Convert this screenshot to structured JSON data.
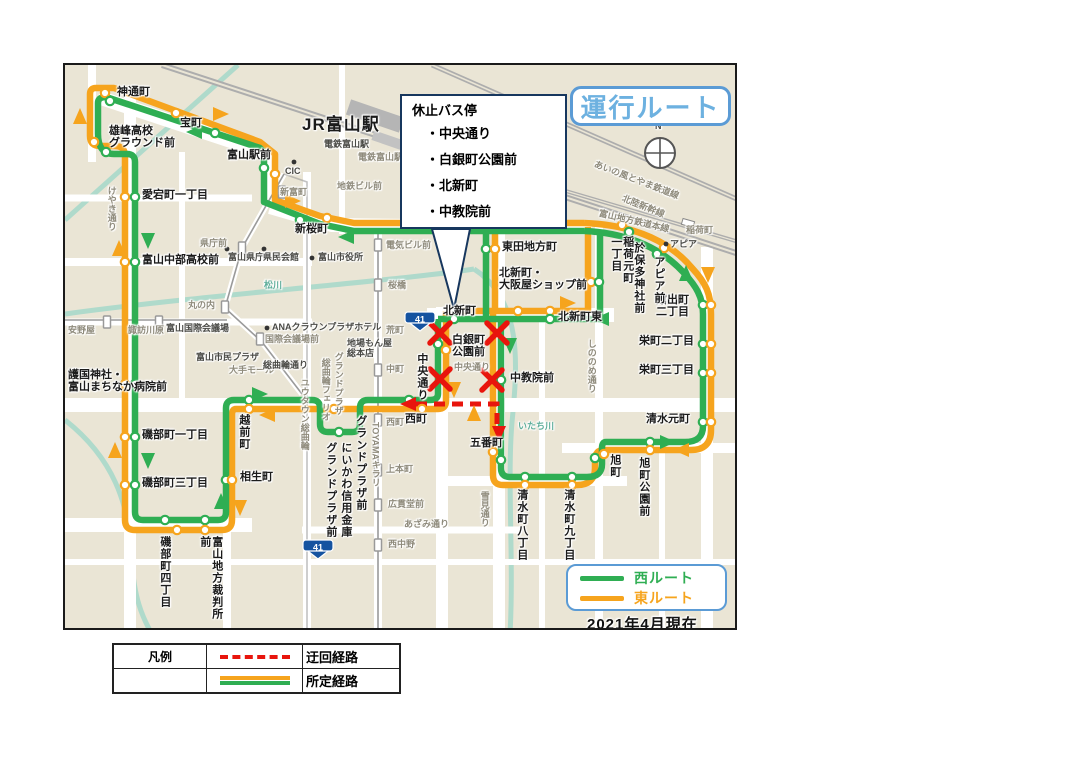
{
  "title": "運行ルート",
  "note": "2021年4月現在",
  "compass_n": "N",
  "callout": {
    "title": "休止バス停",
    "items": [
      "・中央通り",
      "・白銀町公園前",
      "・北新町",
      "・中教院前"
    ]
  },
  "route_legend": {
    "west": "西ルート",
    "east": "東ルート"
  },
  "legend_table": {
    "header": "凡例",
    "rows": [
      {
        "label": "迂回経路"
      },
      {
        "label": "所定経路"
      }
    ]
  },
  "colors": {
    "green": "#2fae53",
    "orange": "#f6a41d",
    "red": "#e8150d",
    "title_blue": "#6db1e0",
    "box_border_blue": "#5b9bd5",
    "water": "#a9d8ca",
    "rail": "#adadad",
    "map_bg": "#eae5d5",
    "shield_blue": "#1553a0"
  },
  "shields": [
    {
      "num": "41",
      "x": 418,
      "y": 318
    },
    {
      "num": "41",
      "x": 316,
      "y": 546
    }
  ],
  "map": {
    "labels": [
      {
        "t": "神通町",
        "x": 115,
        "y": 85,
        "cls": "s"
      },
      {
        "t": "宝町",
        "x": 178,
        "y": 116,
        "cls": "s"
      },
      {
        "t": "雄峰高校\nグラウンド前",
        "x": 107,
        "y": 124,
        "cls": "s"
      },
      {
        "t": "愛宕町一丁目",
        "x": 140,
        "y": 188,
        "cls": "s"
      },
      {
        "t": "富山中部高校前",
        "x": 140,
        "y": 253,
        "cls": "s"
      },
      {
        "t": "護国神社・\n富山まちなか病院前",
        "x": 66,
        "y": 368,
        "cls": "s"
      },
      {
        "t": "磯部町一丁目",
        "x": 140,
        "y": 428,
        "cls": "s"
      },
      {
        "t": "磯部町三丁目",
        "x": 140,
        "y": 476,
        "cls": "s"
      },
      {
        "t": "磯部町四丁目",
        "x": 156,
        "y": 534,
        "cls": "v"
      },
      {
        "t": "富山地方裁判所前",
        "x": 196,
        "y": 534,
        "cls": "v"
      },
      {
        "t": "相生町",
        "x": 238,
        "y": 470,
        "cls": "s"
      },
      {
        "t": "越前町",
        "x": 235,
        "y": 412,
        "cls": "v"
      },
      {
        "t": "グランドプラザ前",
        "x": 352,
        "y": 413,
        "cls": "v"
      },
      {
        "t": "にいかわ信用金庫",
        "x": 337,
        "y": 440,
        "cls": "v"
      },
      {
        "t": "グランドプラザ前",
        "x": 322,
        "y": 440,
        "cls": "v"
      },
      {
        "t": "TOYAMAキラリ",
        "x": 368,
        "y": 420,
        "cls": "vg"
      },
      {
        "t": "西町",
        "x": 403,
        "y": 412,
        "cls": "s"
      },
      {
        "t": "富山駅前",
        "x": 225,
        "y": 148,
        "cls": "s"
      },
      {
        "t": "JR富山駅",
        "x": 300,
        "y": 114,
        "cls": "sb"
      },
      {
        "t": "電鉄富山駅",
        "x": 322,
        "y": 138,
        "cls": "sm2"
      },
      {
        "t": "電鉄富山駅エスタ前",
        "x": 356,
        "y": 151,
        "cls": "sm"
      },
      {
        "t": "CIC",
        "x": 283,
        "y": 165,
        "cls": "sm2"
      },
      {
        "t": "新富町",
        "x": 278,
        "y": 186,
        "cls": "sm"
      },
      {
        "t": "地鉄ビル前",
        "x": 335,
        "y": 180,
        "cls": "sm"
      },
      {
        "t": "新桜町",
        "x": 293,
        "y": 222,
        "cls": "s"
      },
      {
        "t": "電気ビル前",
        "x": 384,
        "y": 239,
        "cls": "sm"
      },
      {
        "t": "桜橋",
        "x": 386,
        "y": 279,
        "cls": "sm"
      },
      {
        "t": "県庁前",
        "x": 198,
        "y": 237,
        "cls": "sm"
      },
      {
        "t": "富山県庁",
        "x": 226,
        "y": 251,
        "cls": "sm2"
      },
      {
        "t": "県民会館",
        "x": 261,
        "y": 251,
        "cls": "sm2"
      },
      {
        "t": "富山市役所",
        "x": 316,
        "y": 251,
        "cls": "sm2"
      },
      {
        "t": "松川",
        "x": 262,
        "y": 279,
        "cls": "teal"
      },
      {
        "t": "丸の内",
        "x": 186,
        "y": 299,
        "cls": "sm"
      },
      {
        "t": "安野屋",
        "x": 66,
        "y": 324,
        "cls": "sm"
      },
      {
        "t": "諏訪川原",
        "x": 126,
        "y": 324,
        "cls": "sm"
      },
      {
        "t": "富山国際会議場",
        "x": 164,
        "y": 322,
        "cls": "sm2"
      },
      {
        "t": "ANAクラウンプラザホテル",
        "x": 270,
        "y": 321,
        "cls": "sm2"
      },
      {
        "t": "国際会議場前",
        "x": 263,
        "y": 333,
        "cls": "sm"
      },
      {
        "t": "富山市民プラザ",
        "x": 194,
        "y": 351,
        "cls": "sm2"
      },
      {
        "t": "大手モール",
        "x": 227,
        "y": 364,
        "cls": "sm"
      },
      {
        "t": "総曲輪通り",
        "x": 261,
        "y": 359,
        "cls": "sm2"
      },
      {
        "t": "地場もん屋\n総本店",
        "x": 345,
        "y": 337,
        "cls": "sm2"
      },
      {
        "t": "グランドプラザ",
        "x": 331,
        "y": 350,
        "cls": "vg"
      },
      {
        "t": "総曲輪フェリオ",
        "x": 318,
        "y": 356,
        "cls": "vg"
      },
      {
        "t": "ユウタウン総曲輪",
        "x": 297,
        "y": 376,
        "cls": "vg"
      },
      {
        "t": "中町",
        "x": 384,
        "y": 363,
        "cls": "sm"
      },
      {
        "t": "荒町",
        "x": 384,
        "y": 324,
        "cls": "sm"
      },
      {
        "t": "西町",
        "x": 384,
        "y": 416,
        "cls": "sm"
      },
      {
        "t": "上本町",
        "x": 384,
        "y": 463,
        "cls": "sm"
      },
      {
        "t": "広貫堂前",
        "x": 386,
        "y": 498,
        "cls": "sm"
      },
      {
        "t": "西中野",
        "x": 386,
        "y": 538,
        "cls": "sm"
      },
      {
        "t": "あざみ通り",
        "x": 402,
        "y": 518,
        "cls": "sm"
      },
      {
        "t": "雪見通り",
        "x": 477,
        "y": 489,
        "cls": "vg"
      },
      {
        "t": "けやき通り",
        "x": 104,
        "y": 184,
        "cls": "vg"
      },
      {
        "t": "しののめ通り",
        "x": 584,
        "y": 337,
        "cls": "vg"
      },
      {
        "t": "いたち川",
        "x": 516,
        "y": 420,
        "cls": "teal"
      },
      {
        "t": "東田地方町",
        "x": 500,
        "y": 240,
        "cls": "s"
      },
      {
        "t": "北新町・\n大阪屋ショップ前",
        "x": 497,
        "y": 266,
        "cls": "s"
      },
      {
        "t": "北新町",
        "x": 441,
        "y": 304,
        "cls": "s"
      },
      {
        "t": "北新町東",
        "x": 556,
        "y": 310,
        "cls": "s"
      },
      {
        "t": "白銀町\n公園前",
        "x": 450,
        "y": 333,
        "cls": "s"
      },
      {
        "t": "中央通り",
        "x": 452,
        "y": 361,
        "cls": "sm"
      },
      {
        "t": "中央通り",
        "x": 413,
        "y": 351,
        "cls": "v"
      },
      {
        "t": "中教院前",
        "x": 508,
        "y": 371,
        "cls": "s"
      },
      {
        "t": "五番町",
        "x": 468,
        "y": 436,
        "cls": "s"
      },
      {
        "t": "清水町八丁目",
        "x": 513,
        "y": 487,
        "cls": "v"
      },
      {
        "t": "清水町九丁目",
        "x": 560,
        "y": 487,
        "cls": "v"
      },
      {
        "t": "旭町",
        "x": 606,
        "y": 452,
        "cls": "v"
      },
      {
        "t": "旭町公園前",
        "x": 635,
        "y": 455,
        "cls": "v"
      },
      {
        "t": "清水元町",
        "x": 644,
        "y": 412,
        "cls": "s"
      },
      {
        "t": "栄町二丁目",
        "x": 637,
        "y": 334,
        "cls": "s"
      },
      {
        "t": "栄町三丁目",
        "x": 637,
        "y": 363,
        "cls": "s"
      },
      {
        "t": "館出町\n二丁目",
        "x": 654,
        "y": 293,
        "cls": "s"
      },
      {
        "t": "アピア前",
        "x": 650,
        "y": 254,
        "cls": "v"
      },
      {
        "t": "稲荷元町\n一丁目",
        "x": 607,
        "y": 234,
        "cls": "v"
      },
      {
        "t": "於保多神社前",
        "x": 630,
        "y": 240,
        "cls": "v"
      },
      {
        "t": "アピア",
        "x": 668,
        "y": 238,
        "cls": "sm2"
      },
      {
        "t": "稲荷町",
        "x": 684,
        "y": 224,
        "cls": "sm"
      },
      {
        "t": "富山地方鉄道本線",
        "x": 598,
        "y": 207,
        "cls": "sm",
        "rot": 13
      },
      {
        "t": "あいの風とやま鉄道線",
        "x": 594,
        "y": 158,
        "cls": "sm",
        "rot": 21
      },
      {
        "t": "北陸新幹線",
        "x": 622,
        "y": 192,
        "cls": "sm",
        "rot": 22
      },
      {
        "t": "N",
        "x": 653,
        "y": 120,
        "cls": "sm2"
      }
    ],
    "stops": [
      {
        "x": 103,
        "y": 91,
        "c": "o"
      },
      {
        "x": 108,
        "y": 99,
        "c": "g"
      },
      {
        "x": 174,
        "y": 111,
        "c": "o"
      },
      {
        "x": 213,
        "y": 131,
        "c": "g"
      },
      {
        "x": 92,
        "y": 140,
        "c": "o"
      },
      {
        "x": 104,
        "y": 150,
        "c": "g"
      },
      {
        "x": 123,
        "y": 195,
        "c": "o"
      },
      {
        "x": 133,
        "y": 195,
        "c": "g"
      },
      {
        "x": 123,
        "y": 260,
        "c": "o"
      },
      {
        "x": 133,
        "y": 260,
        "c": "g"
      },
      {
        "x": 123,
        "y": 382,
        "c": "o"
      },
      {
        "x": 133,
        "y": 382,
        "c": "g"
      },
      {
        "x": 123,
        "y": 435,
        "c": "o"
      },
      {
        "x": 133,
        "y": 435,
        "c": "g"
      },
      {
        "x": 123,
        "y": 483,
        "c": "o"
      },
      {
        "x": 133,
        "y": 483,
        "c": "g"
      },
      {
        "x": 163,
        "y": 518,
        "c": "g"
      },
      {
        "x": 175,
        "y": 528,
        "c": "o"
      },
      {
        "x": 203,
        "y": 518,
        "c": "g"
      },
      {
        "x": 203,
        "y": 528,
        "c": "o"
      },
      {
        "x": 224,
        "y": 478,
        "c": "g"
      },
      {
        "x": 230,
        "y": 478,
        "c": "o"
      },
      {
        "x": 247,
        "y": 398,
        "c": "g"
      },
      {
        "x": 247,
        "y": 407,
        "c": "o"
      },
      {
        "x": 332,
        "y": 407,
        "c": "o"
      },
      {
        "x": 337,
        "y": 430,
        "c": "g"
      },
      {
        "x": 407,
        "y": 398,
        "c": "g"
      },
      {
        "x": 420,
        "y": 407,
        "c": "o"
      },
      {
        "x": 262,
        "y": 166,
        "c": "g"
      },
      {
        "x": 273,
        "y": 172,
        "c": "o"
      },
      {
        "x": 298,
        "y": 218,
        "c": "g"
      },
      {
        "x": 325,
        "y": 216,
        "c": "o"
      },
      {
        "x": 484,
        "y": 247,
        "c": "g"
      },
      {
        "x": 493,
        "y": 247,
        "c": "o"
      },
      {
        "x": 452,
        "y": 309,
        "c": "o"
      },
      {
        "x": 452,
        "y": 317,
        "c": "g"
      },
      {
        "x": 516,
        "y": 309,
        "c": "o"
      },
      {
        "x": 548,
        "y": 309,
        "c": "o"
      },
      {
        "x": 548,
        "y": 317,
        "c": "g"
      },
      {
        "x": 589,
        "y": 280,
        "c": "o"
      },
      {
        "x": 597,
        "y": 280,
        "c": "g"
      },
      {
        "x": 620,
        "y": 223,
        "c": "o"
      },
      {
        "x": 627,
        "y": 230,
        "c": "g"
      },
      {
        "x": 662,
        "y": 246,
        "c": "o"
      },
      {
        "x": 655,
        "y": 252,
        "c": "g"
      },
      {
        "x": 701,
        "y": 303,
        "c": "g"
      },
      {
        "x": 709,
        "y": 303,
        "c": "o"
      },
      {
        "x": 701,
        "y": 342,
        "c": "g"
      },
      {
        "x": 709,
        "y": 342,
        "c": "o"
      },
      {
        "x": 701,
        "y": 371,
        "c": "g"
      },
      {
        "x": 709,
        "y": 371,
        "c": "o"
      },
      {
        "x": 701,
        "y": 420,
        "c": "g"
      },
      {
        "x": 709,
        "y": 420,
        "c": "o"
      },
      {
        "x": 648,
        "y": 440,
        "c": "g"
      },
      {
        "x": 648,
        "y": 448,
        "c": "o"
      },
      {
        "x": 593,
        "y": 456,
        "c": "g"
      },
      {
        "x": 602,
        "y": 452,
        "c": "o"
      },
      {
        "x": 570,
        "y": 475,
        "c": "g"
      },
      {
        "x": 570,
        "y": 483,
        "c": "o"
      },
      {
        "x": 523,
        "y": 475,
        "c": "g"
      },
      {
        "x": 523,
        "y": 483,
        "c": "o"
      },
      {
        "x": 499,
        "y": 458,
        "c": "g"
      },
      {
        "x": 491,
        "y": 450,
        "c": "o"
      },
      {
        "x": 436,
        "y": 342,
        "c": "g"
      },
      {
        "x": 444,
        "y": 348,
        "c": "o"
      },
      {
        "x": 499,
        "y": 378,
        "c": "g"
      },
      {
        "x": 376,
        "y": 243,
        "c": "t"
      },
      {
        "x": 376,
        "y": 283,
        "c": "t"
      },
      {
        "x": 376,
        "y": 368,
        "c": "t"
      },
      {
        "x": 376,
        "y": 418,
        "c": "t"
      },
      {
        "x": 376,
        "y": 468,
        "c": "t"
      },
      {
        "x": 376,
        "y": 503,
        "c": "t"
      },
      {
        "x": 376,
        "y": 543,
        "c": "t"
      },
      {
        "x": 280,
        "y": 190,
        "c": "t"
      },
      {
        "x": 240,
        "y": 246,
        "c": "t"
      },
      {
        "x": 223,
        "y": 305,
        "c": "t"
      },
      {
        "x": 258,
        "y": 337,
        "c": "t"
      },
      {
        "x": 105,
        "y": 320,
        "c": "t"
      },
      {
        "x": 157,
        "y": 320,
        "c": "t"
      },
      {
        "x": 292,
        "y": 160,
        "c": "d"
      },
      {
        "x": 225,
        "y": 247,
        "c": "d"
      },
      {
        "x": 262,
        "y": 247,
        "c": "d"
      },
      {
        "x": 310,
        "y": 256,
        "c": "d"
      },
      {
        "x": 200,
        "y": 327,
        "c": "d"
      },
      {
        "x": 265,
        "y": 326,
        "c": "d"
      },
      {
        "x": 215,
        "y": 356,
        "c": "d"
      },
      {
        "x": 352,
        "y": 344,
        "c": "d"
      },
      {
        "x": 664,
        "y": 242,
        "c": "d"
      }
    ],
    "arrows": [
      {
        "x": 78,
        "y": 115,
        "d": "up",
        "c": "o"
      },
      {
        "x": 218,
        "y": 112,
        "d": "right",
        "c": "o"
      },
      {
        "x": 193,
        "y": 130,
        "d": "left",
        "c": "g"
      },
      {
        "x": 290,
        "y": 199,
        "d": "right",
        "c": "o"
      },
      {
        "x": 345,
        "y": 235,
        "d": "left",
        "c": "g"
      },
      {
        "x": 117,
        "y": 247,
        "d": "up",
        "c": "o"
      },
      {
        "x": 146,
        "y": 238,
        "d": "down",
        "c": "g"
      },
      {
        "x": 565,
        "y": 301,
        "d": "right",
        "c": "o"
      },
      {
        "x": 600,
        "y": 317,
        "d": "left",
        "c": "g"
      },
      {
        "x": 508,
        "y": 343,
        "d": "down",
        "c": "g"
      },
      {
        "x": 452,
        "y": 387,
        "d": "down",
        "c": "o"
      },
      {
        "x": 472,
        "y": 412,
        "d": "up",
        "c": "o"
      },
      {
        "x": 257,
        "y": 392,
        "d": "right",
        "c": "g"
      },
      {
        "x": 266,
        "y": 413,
        "d": "left",
        "c": "o"
      },
      {
        "x": 219,
        "y": 500,
        "d": "up",
        "c": "g"
      },
      {
        "x": 238,
        "y": 505,
        "d": "down",
        "c": "o"
      },
      {
        "x": 113,
        "y": 449,
        "d": "up",
        "c": "o"
      },
      {
        "x": 146,
        "y": 458,
        "d": "down",
        "c": "g"
      },
      {
        "x": 665,
        "y": 440,
        "d": "right",
        "c": "g"
      },
      {
        "x": 680,
        "y": 448,
        "d": "left",
        "c": "o"
      },
      {
        "x": 706,
        "y": 272,
        "d": "down",
        "c": "o"
      },
      {
        "x": 684,
        "y": 272,
        "d": "up",
        "c": "g"
      },
      {
        "x": 407,
        "y": 402,
        "d": "left",
        "c": "r"
      },
      {
        "x": 497,
        "y": 431,
        "d": "down",
        "c": "r"
      }
    ],
    "x_marks": [
      {
        "x": 438,
        "y": 331
      },
      {
        "x": 495,
        "y": 331
      },
      {
        "x": 438,
        "y": 377
      },
      {
        "x": 490,
        "y": 378
      }
    ]
  }
}
